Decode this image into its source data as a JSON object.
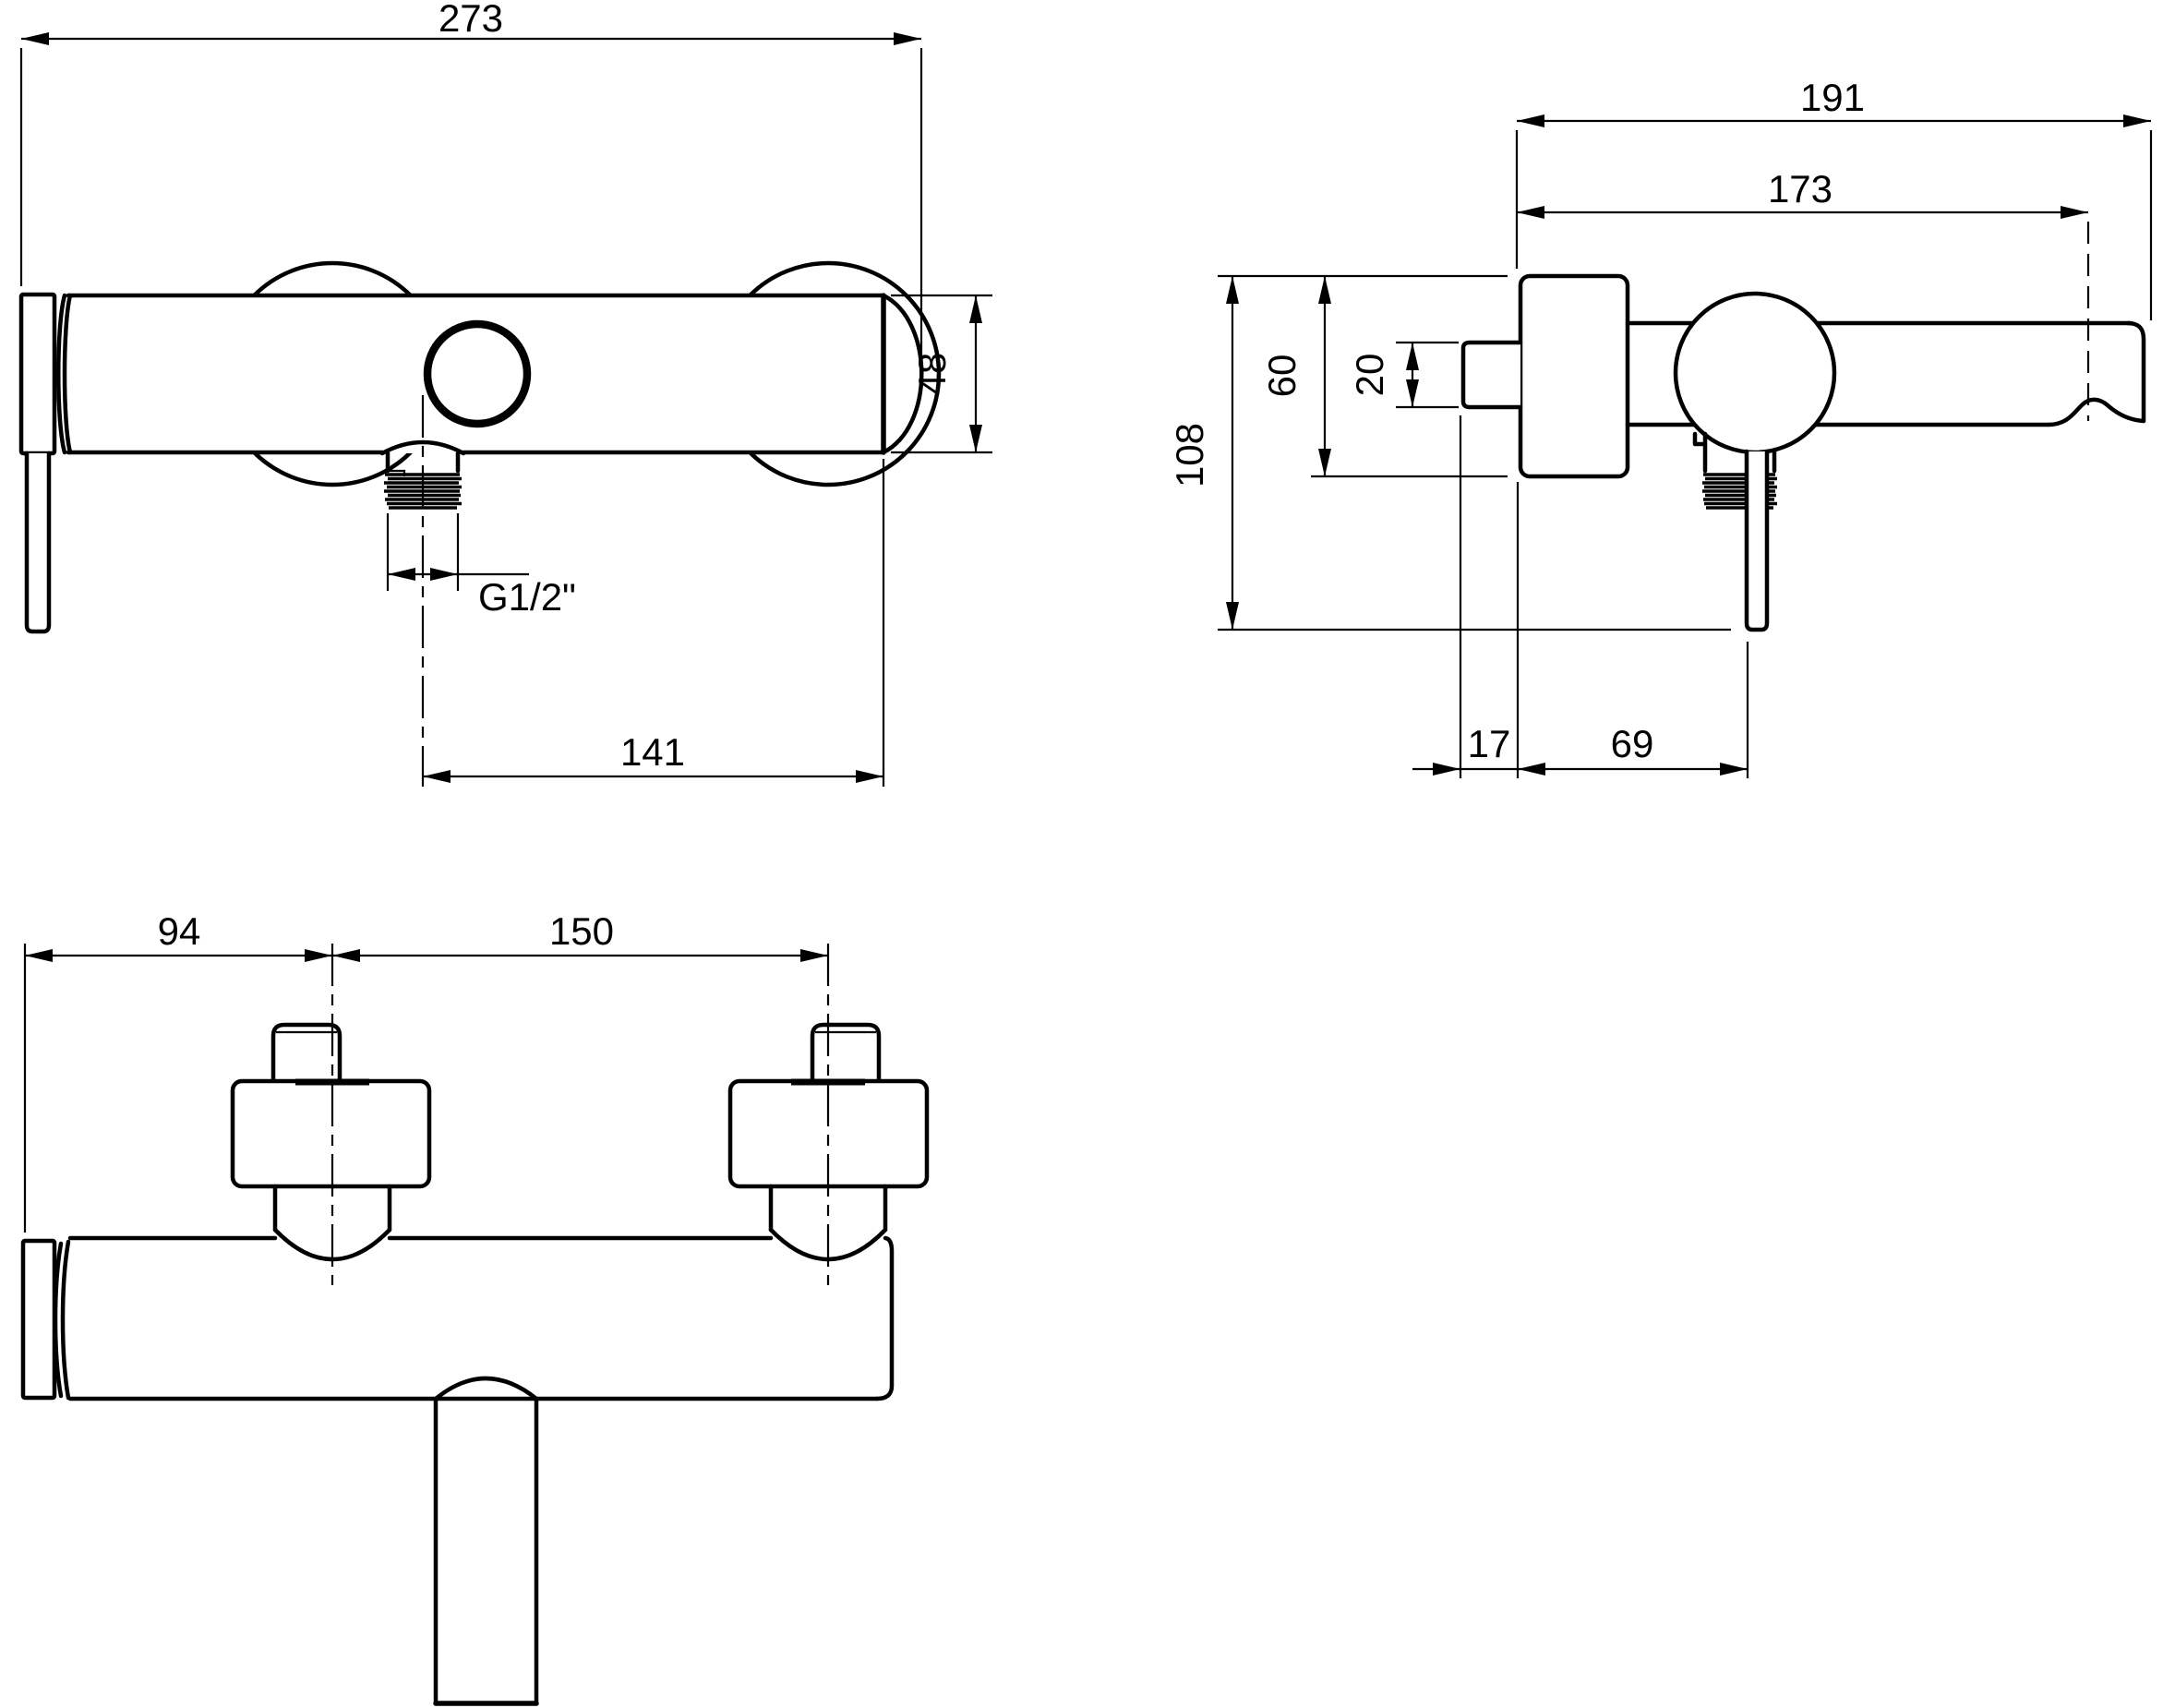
{
  "drawing_title": "wall-mounted-shower-mixer-dimensional-drawing",
  "front_view": {
    "dimensions": {
      "overall_width": "273",
      "body_height": "48",
      "outlet_to_right_end": "141",
      "outlet_thread": "G1/2\""
    }
  },
  "side_view": {
    "dimensions": {
      "overall_depth": "191",
      "depth_to_spout_axis": "173",
      "overall_height": "108",
      "flange_height": "60",
      "supply_pipe_diameter": "20",
      "pipe_wall_offset": "17",
      "wall_to_handle_axis": "69"
    }
  },
  "top_view": {
    "dimensions": {
      "end_to_first_leg": "94",
      "leg_spacing": "150"
    }
  },
  "colors": {
    "line": "#000000",
    "background": "#ffffff"
  }
}
